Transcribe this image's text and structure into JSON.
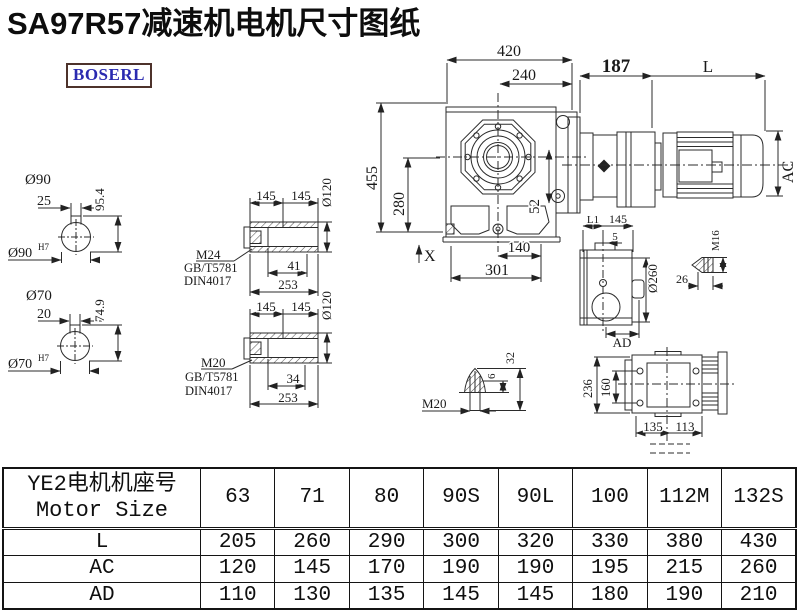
{
  "title": "SA97R57减速机电机尺寸图纸",
  "logo": {
    "text": "BOSERL",
    "text_color": "#2a2ab0",
    "border_color": "#4d322b"
  },
  "drawing": {
    "shaft_90": {
      "dia": "Ø90",
      "key_width": "25",
      "key_depth": "95.4",
      "bore": "Ø90",
      "bore_fit": "H7"
    },
    "shaft_70": {
      "dia": "Ø70",
      "key_width": "20",
      "key_depth": "74.9",
      "bore": "Ø70",
      "bore_fit": "H7"
    },
    "hollow_upper": {
      "len_a": "145",
      "len_b": "145",
      "dia": "Ø120",
      "thread": "M24",
      "std_gb": "GB/T5781",
      "std_din": "DIN4017",
      "thread_len": "41",
      "total_len": "253"
    },
    "hollow_lower": {
      "len_a": "145",
      "len_b": "145",
      "dia": "Ø120",
      "thread": "M20",
      "std_gb": "GB/T5781",
      "std_din": "DIN4017",
      "thread_len": "34",
      "total_len": "253"
    },
    "front_view": {
      "width": "420",
      "flange_width": "240",
      "motor_offset": "187",
      "motor_len": "L",
      "height": "455",
      "center_height": "280",
      "hole_offset": "52",
      "foot_mark": "X",
      "foot_width": "140",
      "base_width": "301",
      "motor_dia": "AC"
    },
    "side_view": {
      "dim_l1": "L1",
      "dim_145": "145",
      "dim_5": "5",
      "flange_dia": "Ø260",
      "dim_ad": "AD"
    },
    "plug_m16": {
      "thread": "M16",
      "length": "26"
    },
    "plug_m20": {
      "thread": "M20",
      "tip": "6",
      "length": "32"
    },
    "back_view": {
      "height": "236",
      "bolt_spacing": "160",
      "width_left": "135",
      "width_right": "113"
    }
  },
  "table": {
    "header_cn": "YE2电机机座号",
    "header_en": "Motor Size",
    "columns": [
      "63",
      "71",
      "80",
      "90S",
      "90L",
      "100",
      "112M",
      "132S"
    ],
    "rows": [
      {
        "label": "L",
        "values": [
          "205",
          "260",
          "290",
          "300",
          "320",
          "330",
          "380",
          "430"
        ]
      },
      {
        "label": "AC",
        "values": [
          "120",
          "145",
          "170",
          "190",
          "190",
          "195",
          "215",
          "260"
        ]
      },
      {
        "label": "AD",
        "values": [
          "110",
          "130",
          "135",
          "145",
          "145",
          "180",
          "190",
          "210"
        ]
      }
    ]
  }
}
